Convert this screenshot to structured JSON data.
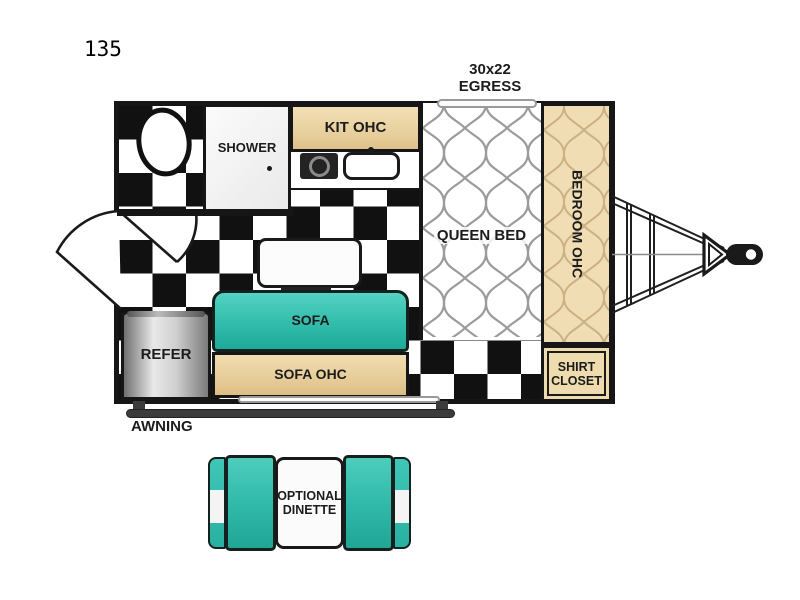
{
  "title": {
    "model": "135"
  },
  "floorplan": {
    "egress_label": "30x22\nEGRESS",
    "shower_label": "SHOWER",
    "kit_ohc_label": "KIT OHC",
    "queen_bed_label": "QUEEN BED",
    "bedroom_ohc_label": "BEDROOM OHC",
    "shirt_closet_label": "SHIRT\nCLOSET",
    "sofa_label": "SOFA",
    "sofa_ohc_label": "SOFA OHC",
    "refer_label": "REFER",
    "awning_label": "AWNING"
  },
  "dinette": {
    "label": "OPTIONAL\nDINETTE"
  },
  "colors": {
    "teal": "#32bcab",
    "wood_tan": "#e9d1a0",
    "wall_black": "#161616",
    "floor_black": "#111111",
    "silver": "#c9c9c9",
    "pattern_gray": "#9b9b9b"
  }
}
